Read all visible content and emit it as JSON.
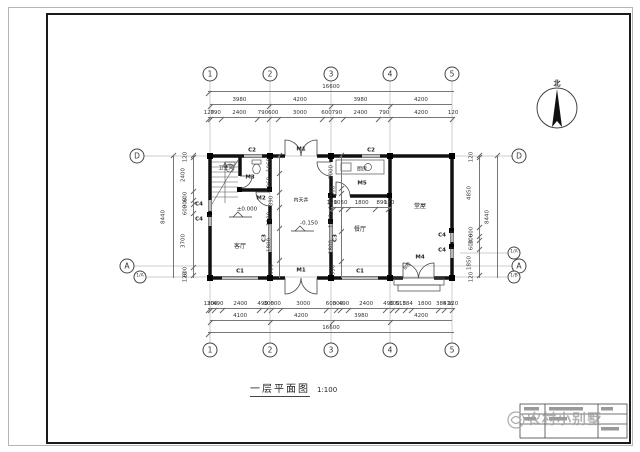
{
  "page": {
    "title": "一层平面图",
    "scale": "1:100",
    "north": "北",
    "watermark": "农村小别墅"
  },
  "grid": {
    "cols": [
      "1",
      "2",
      "3",
      "4",
      "5"
    ],
    "row_d": "D",
    "row_a": "A",
    "row_frac_a": "1/A",
    "row_frac_b": "1/B"
  },
  "rooms": {
    "bath": "卫生间",
    "kitchen": "厨房",
    "living": "客厅",
    "court": "内天井",
    "dining": "餐厅",
    "hall": "堂屋",
    "steps": "台阶"
  },
  "levels": {
    "zero": "±0.000",
    "minus": "-0.150"
  },
  "codes": {
    "m1": "M1",
    "m2": "M2",
    "m3": "M3",
    "m4": "M4",
    "m5": "M5",
    "c1": "C1",
    "c2": "C2",
    "c3": "C3",
    "c4": "C4"
  },
  "dims": {
    "top_total": [
      16600
    ],
    "top_spans": [
      3980,
      4200,
      3980,
      4200
    ],
    "top_detail": [
      120,
      790,
      2400,
      790,
      600,
      3000,
      600,
      790,
      2400,
      790,
      4200,
      120
    ],
    "bottom_detail": [
      120,
      300,
      490,
      2400,
      490,
      300,
      600,
      3000,
      600,
      300,
      490,
      2400,
      490,
      300,
      518,
      384,
      1800,
      384,
      516,
      120
    ],
    "bottom_spans": [
      4100,
      4200,
      3980,
      4200
    ],
    "bottom_total": [
      16600
    ],
    "left_detail": [
      120,
      2400,
      600,
      300,
      600,
      3700,
      600,
      120
    ],
    "left_total": [
      8440
    ],
    "right_detail": [
      120,
      4850,
      600,
      300,
      600,
      1850,
      120
    ],
    "right_total": [
      8440
    ],
    "court_left": [
      1060,
      1060,
      890,
      1200,
      1800,
      990
    ],
    "court_right": [
      2000,
      300,
      1000,
      1350,
      1800,
      990
    ],
    "kitchen": [
      120,
      1050,
      1800,
      890,
      120
    ]
  }
}
